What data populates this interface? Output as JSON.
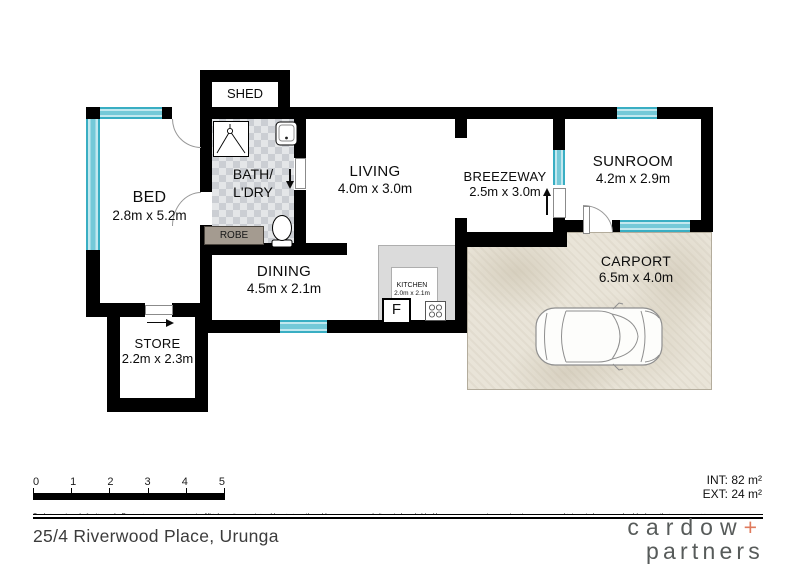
{
  "rooms": {
    "shed": {
      "name": "SHED"
    },
    "bed": {
      "name": "BED",
      "dims": "2.8m x 5.2m"
    },
    "bath": {
      "name1": "BATH/",
      "name2": "L'DRY"
    },
    "living": {
      "name": "LIVING",
      "dims": "4.0m x 3.0m"
    },
    "breezeway": {
      "name": "BREEZEWAY",
      "dims": "2.5m x 3.0m"
    },
    "sunroom": {
      "name": "SUNROOM",
      "dims": "4.2m x 2.9m"
    },
    "dining": {
      "name": "DINING",
      "dims": "4.5m x 2.1m"
    },
    "kitchen": {
      "name": "KITCHEN",
      "dims": "2.0m x 2.1m"
    },
    "store": {
      "name": "STORE",
      "dims": "2.2m x 2.3m"
    },
    "carport": {
      "name": "CARPORT",
      "dims": "6.5m x 4.0m"
    },
    "robe": {
      "name": "ROBE"
    },
    "fridge": {
      "label": "F"
    }
  },
  "scale_bar": {
    "ticks": [
      "0",
      "1",
      "2",
      "3",
      "4",
      "5"
    ]
  },
  "areas": {
    "internal": "INT: 82 m²",
    "external": "EXT: 24 m²"
  },
  "disclaimer": "Scale in metres. Indicative only. Dimensions are approximate. All information contained herein is gathered from sources we believe to be reliable. However, we cannot guarantee its accuracy and interested persons should rely on their own enquiries.",
  "address": "25/4 Riverwood Place, Urunga",
  "logo": {
    "word1": "cardow",
    "plus": "+",
    "word2": "partners"
  },
  "colors": {
    "window": "#74c9d8",
    "logo_text": "#575b5a",
    "logo_accent": "#df7a5c",
    "carport_floor": "#e9e4d8"
  }
}
